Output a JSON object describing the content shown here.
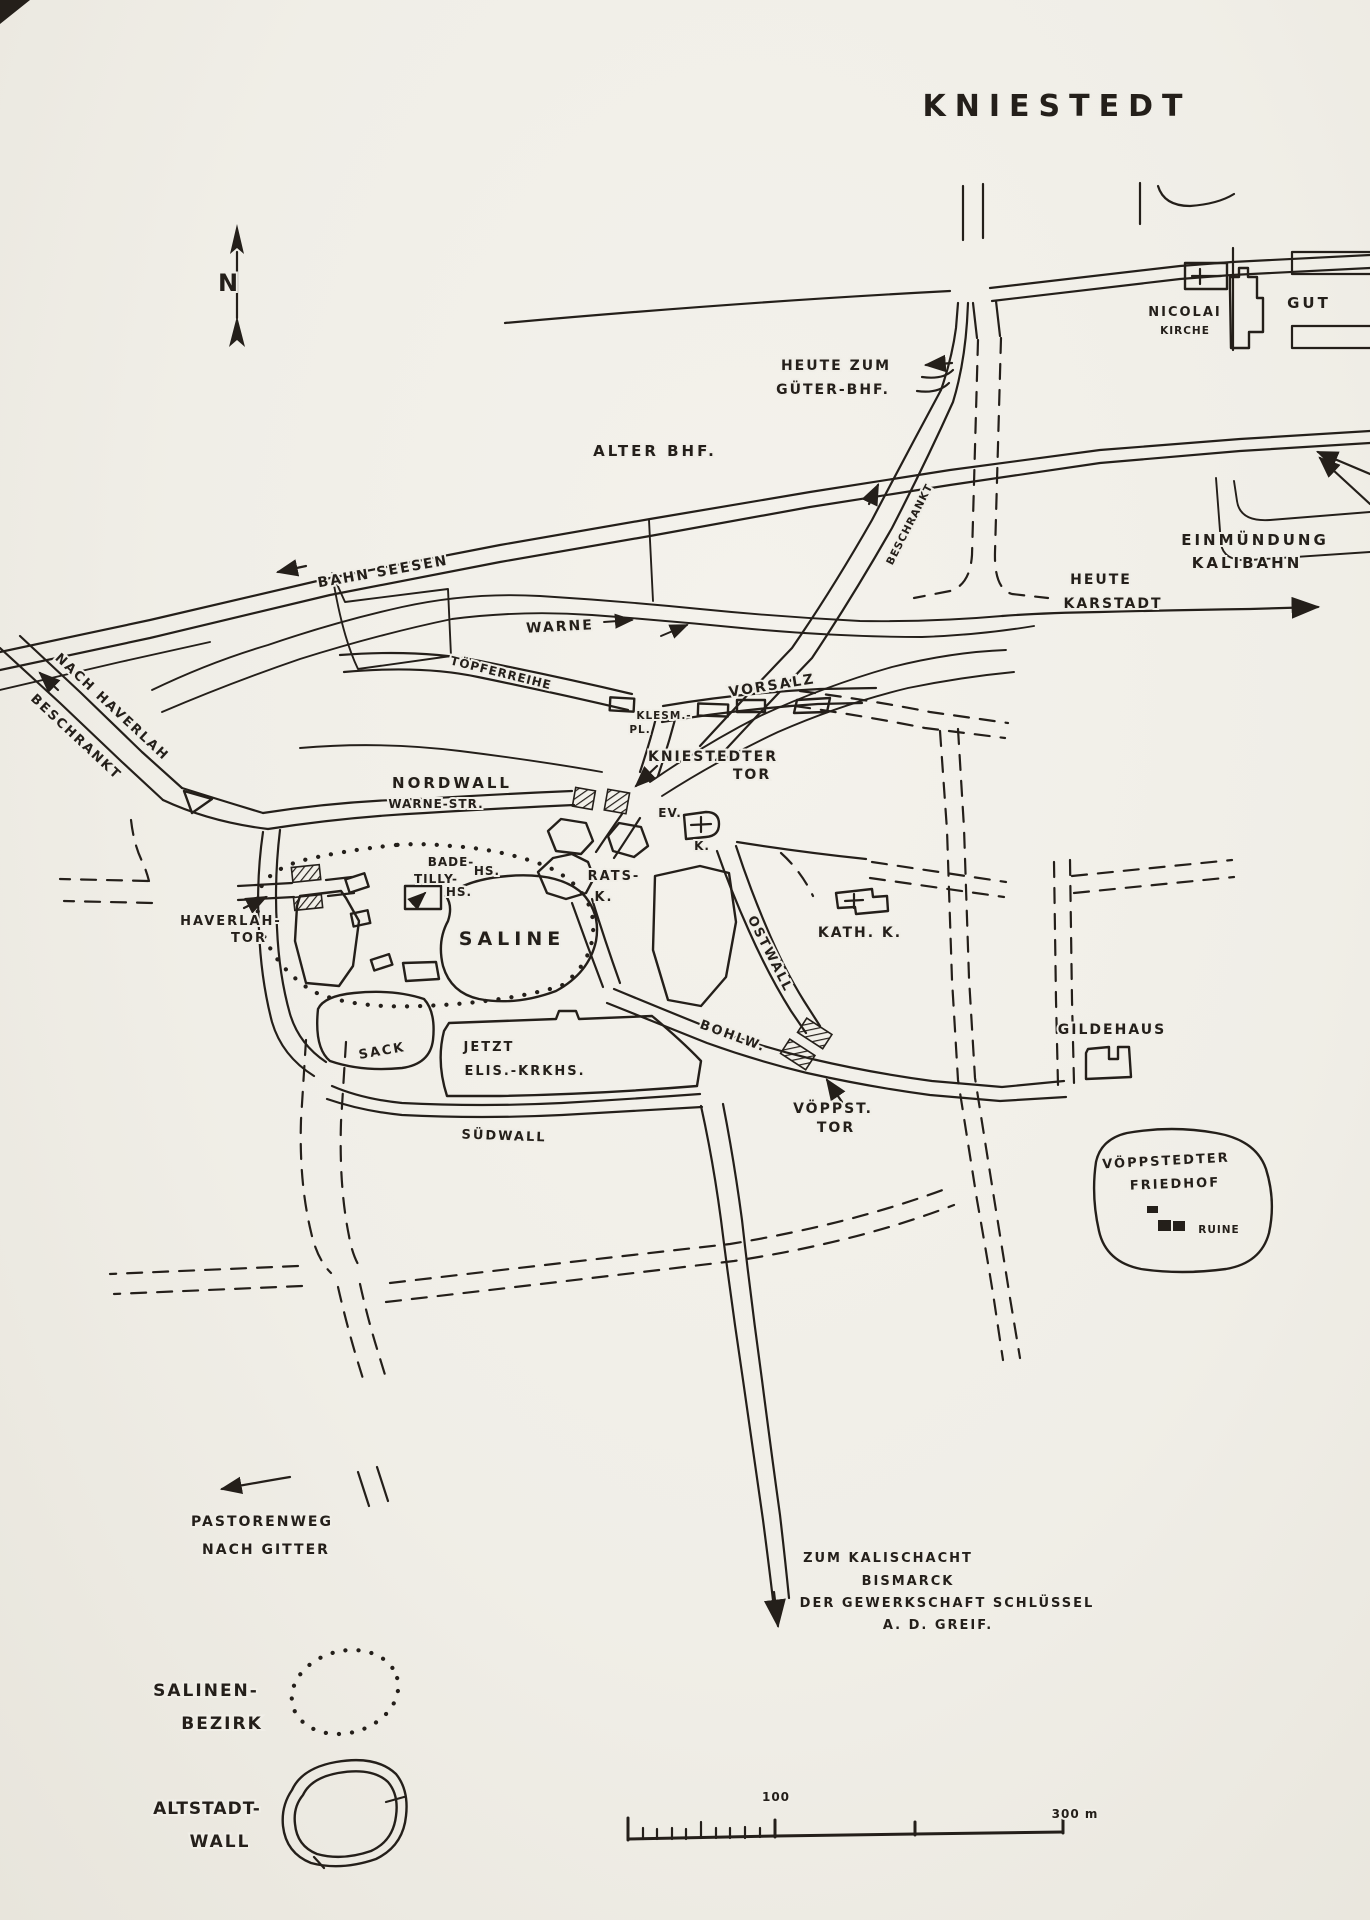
{
  "map": {
    "title": "KNIESTEDT",
    "compass_n": "N",
    "colors": {
      "paper": "#f0eee7",
      "ink": "#241f1a"
    },
    "labels": {
      "nicolai_line1": "NICOLAI",
      "nicolai_line2": "KIRCHE",
      "gut": "GUT",
      "heute_zum": "HEUTE ZUM",
      "gueter_bhf": "GÜTER-BHF.",
      "alter_bhf": "ALTER BHF.",
      "bahn_seesen": "BAHN SEESEN",
      "einmuendung_line1": "EINMÜNDUNG",
      "einmuendung_line2": "KALIBAHN",
      "heute": "HEUTE",
      "karstadt": "KARSTADT",
      "warne": "WARNE",
      "nach_haverlah": "NACH HAVERLAH",
      "beschrankt_west": "BESCHRANKT",
      "beschrankt_north": "BESCHRANKT",
      "toepferreihe": "TÖPFERREIHE",
      "vorsalz": "VORSALZ",
      "klesm_line1": "KLESM.-",
      "klesm_line2": "PL.",
      "kniestedter_line1": "KNIESTEDTER",
      "kniestedter_line2": "TOR",
      "nordwall": "NORDWALL",
      "warne_str": "WARNE-STR.",
      "ev_line1": "EV.",
      "ev_line2": "K.",
      "bade_line1": "BADE-",
      "bade_line2": "HS.",
      "tilly_line1": "TILLY-",
      "tilly_line2": "HS.",
      "rats_line1": "RATS-",
      "rats_line2": "K.",
      "kath_k": "KATH. K.",
      "haverlah_line1": "HAVERLAH-",
      "haverlah_line2": "TOR",
      "saline": "SALINE",
      "ostwall": "OSTWALL",
      "bohlw": "BOHLW.",
      "gildehaus": "GILDEHAUS",
      "sack": "SACK",
      "jetzt": "JETZT",
      "elis_krkhs": "ELIS.-KRKHS.",
      "suedwall": "SÜDWALL",
      "voeppst_line1": "VÖPPST.",
      "voeppst_line2": "TOR",
      "friedhof_line1": "VÖPPSTEDTER",
      "friedhof_line2": "FRIEDHOF",
      "ruine": "RUINE",
      "pastorenweg_line1": "PASTORENWEG",
      "pastorenweg_line2": "NACH GITTER",
      "kalischacht_line1": "ZUM KALISCHACHT",
      "kalischacht_line2": "BISMARCK",
      "kalischacht_line3": "DER GEWERKSCHAFT SCHLÜSSEL",
      "kalischacht_line4": "A. D. GREIF."
    },
    "legend": {
      "salinen_line1": "SALINEN-",
      "salinen_line2": "BEZIRK",
      "altstadt_line1": "ALTSTADT-",
      "altstadt_line2": "WALL"
    },
    "scale": {
      "mark_100": "100",
      "mark_300": "300 m"
    }
  }
}
